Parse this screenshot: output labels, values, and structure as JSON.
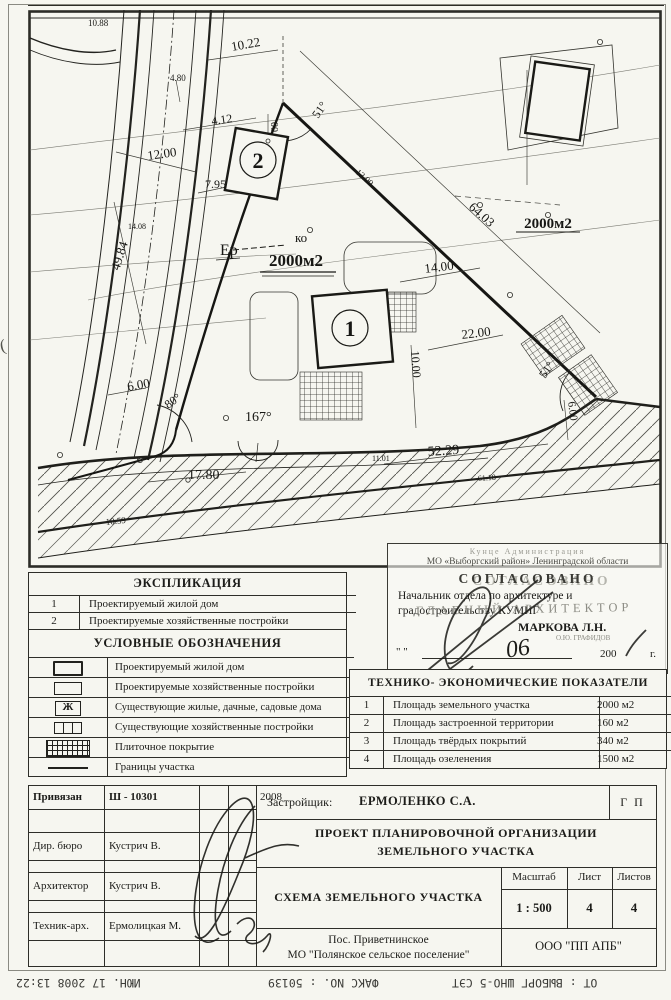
{
  "map": {
    "labels": [
      {
        "t": "10.88",
        "x": 60,
        "y": 16,
        "s": 9
      },
      {
        "t": "10.22",
        "x": 204,
        "y": 41,
        "s": 13,
        "r": -10
      },
      {
        "t": "4.80",
        "x": 142,
        "y": 71,
        "s": 9
      },
      {
        "t": "4.12",
        "x": 184,
        "y": 115,
        "s": 12,
        "r": -8
      },
      {
        "t": "12.00",
        "x": 120,
        "y": 150,
        "s": 13,
        "r": -8
      },
      {
        "t": "7.95",
        "x": 177,
        "y": 178,
        "s": 12
      },
      {
        "t": "00",
        "x": 243,
        "y": 112,
        "s": 10,
        "r": 90
      },
      {
        "t": "51°",
        "x": 290,
        "y": 109,
        "s": 12,
        "r": -55
      },
      {
        "t": "13.00",
        "x": 327,
        "y": 163,
        "s": 9,
        "r": 42
      },
      {
        "t": "64.03",
        "x": 440,
        "y": 198,
        "s": 13,
        "r": 42
      },
      {
        "t": "2000м2",
        "x": 520,
        "y": 218,
        "s": 15,
        "w": "bold",
        "a": "middle"
      },
      {
        "t": "Ер",
        "x": 192,
        "y": 245,
        "s": 16
      },
      {
        "t": "ко",
        "x": 267,
        "y": 232,
        "s": 13
      },
      {
        "t": "2000м2",
        "x": 268,
        "y": 256,
        "s": 17,
        "w": "bold",
        "a": "middle"
      },
      {
        "t": "14.00",
        "x": 397,
        "y": 263,
        "s": 13,
        "r": -7
      },
      {
        "t": "22.00",
        "x": 434,
        "y": 329,
        "s": 13,
        "r": -7
      },
      {
        "t": "10.00",
        "x": 383,
        "y": 341,
        "s": 12,
        "r": 86
      },
      {
        "t": "51°",
        "x": 517,
        "y": 369,
        "s": 12,
        "r": -55
      },
      {
        "t": "6.00",
        "x": 540,
        "y": 392,
        "s": 11,
        "r": 82
      },
      {
        "t": "49.84",
        "x": 91,
        "y": 261,
        "s": 13,
        "r": -72
      },
      {
        "t": "14.08",
        "x": 100,
        "y": 219,
        "s": 8
      },
      {
        "t": "6.00",
        "x": 100,
        "y": 381,
        "s": 13,
        "r": -10
      },
      {
        "t": "80°",
        "x": 140,
        "y": 399,
        "s": 12,
        "r": -35
      },
      {
        "t": "167°",
        "x": 217,
        "y": 411,
        "s": 14
      },
      {
        "t": "17.80",
        "x": 160,
        "y": 469,
        "s": 14
      },
      {
        "t": "52.29",
        "x": 400,
        "y": 446,
        "s": 14,
        "r": -4
      },
      {
        "t": "11.01",
        "x": 344,
        "y": 451,
        "s": 8
      },
      {
        "t": "61.18",
        "x": 450,
        "y": 471,
        "s": 8,
        "r": -4
      },
      {
        "t": "10.59",
        "x": 78,
        "y": 515,
        "s": 9,
        "r": -6
      }
    ],
    "buildings": {
      "b1": "1",
      "b2": "2"
    }
  },
  "explication": {
    "title": "ЭКСПЛИКАЦИЯ",
    "rows": [
      {
        "num": "1",
        "label": "Проектируемый жилой дом"
      },
      {
        "num": "2",
        "label": "Проектируемые хозяйственные постройки"
      }
    ]
  },
  "legend": {
    "title": "УСЛОВНЫЕ  ОБОЗНАЧЕНИЯ",
    "rows": [
      {
        "label": "Проектируемый жилой дом"
      },
      {
        "label": "Проектируемые хозяйственные постройки"
      },
      {
        "glyph": "Ж",
        "label": "Существующие жилые, дачные, садовые дома"
      },
      {
        "label": "Существующие хозяйственные постройки"
      },
      {
        "label": "Плиточное покрытие"
      },
      {
        "label": "Границы участка"
      }
    ]
  },
  "stamp": {
    "faint_top": "Кунце Администрация",
    "line1": "МО «Выборгский район» Ленинградской области",
    "approved": "СОГЛАСОВАНО",
    "line2": "Начальник отдела по архитектуре и",
    "line3": "градостроительству КУМИГ",
    "overlay1": "ГЛАВНЫЙ АРХИТЕКТОР",
    "name": "МАРКОВА Л.Н.",
    "overlay2": "О.Ю. ГРАФИДОВ",
    "date_quotes": "\"   \"",
    "hand_date": "06",
    "year": "200",
    "year_suffix": "г."
  },
  "tep": {
    "title": "ТЕХНИКО- ЭКОНОМИЧЕСКИЕ ПОКАЗАТЕЛИ",
    "rows": [
      {
        "num": "1",
        "label": "Площадь земельного участка",
        "value": "2000 м2"
      },
      {
        "num": "2",
        "label": "Площадь застроенной территории",
        "value": "160 м2"
      },
      {
        "num": "3",
        "label": "Площадь твёрдых покрытий",
        "value": "340 м2"
      },
      {
        "num": "4",
        "label": "Площадь озеленения",
        "value": "1500 м2"
      }
    ]
  },
  "titleblock": {
    "row1": {
      "c1": "Привязан",
      "c2": "Ш - 10301",
      "c4": "2008"
    },
    "dir": {
      "role": "Дир. бюро",
      "name": "Кустрич В."
    },
    "arch": {
      "role": "Архитектор",
      "name": "Кустрич В."
    },
    "tech": {
      "role": "Техник-арх.",
      "name": "Ермолицкая М."
    },
    "developer_label": "Застройщик:",
    "developer_name": "ЕРМОЛЕНКО С.А.",
    "gp": "Г П",
    "project_line1": "ПРОЕКТ ПЛАНИРОВОЧНОЙ ОРГАНИЗАЦИИ",
    "project_line2": "ЗЕМЕЛЬНОГО УЧАСТКА",
    "scheme": "СХЕМА ЗЕМЕЛЬНОГО УЧАСТКА",
    "scale_label": "Масштаб",
    "scale": "1 : 500",
    "sheet_label": "Лист",
    "sheet": "4",
    "sheets_label": "Листов",
    "sheets": "4",
    "loc1": "Пос.  Приветнинское",
    "loc2": "МО \"Полянское сельское поселение\"",
    "org": "ООО \"ПП АПБ\""
  },
  "fax": {
    "left": "ИЮН. 17 2008 13:22",
    "mid": "ФАКС NO. : 50139",
    "right": "ОТ : ВЫБОРГ ШНО-5 СЭТ"
  },
  "artifacts": {
    "paren": "("
  }
}
